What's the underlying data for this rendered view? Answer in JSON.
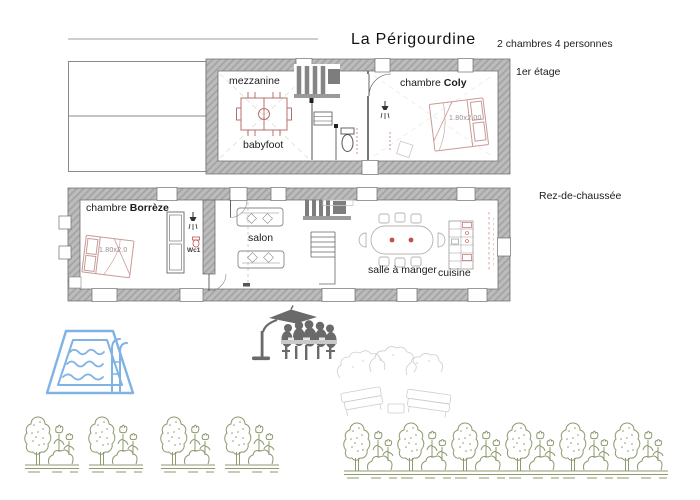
{
  "header": {
    "title": "La Périgourdine",
    "subtitle": "2 chambres 4 personnes"
  },
  "first_floor": {
    "label": "1er étage",
    "mezzanine": "mezzanine",
    "babyfoot": "babyfoot",
    "bedroom_prefix": "chambre ",
    "bedroom_name": "Coly",
    "bed_size": "1.80x2.00"
  },
  "ground_floor": {
    "label": "Rez-de-chaussée",
    "bedroom_prefix": "chambre ",
    "bedroom_name": "Borrèze",
    "bed_size": "1.80x2.0",
    "wc": "Wc1",
    "salon": "salon",
    "dining": "salle à manger",
    "kitchen": "cuisine"
  },
  "icons": {
    "pool": "pool-icon",
    "outdoor_dining": "umbrella-dining-silhouette-icon",
    "garden_sketch": "garden-furniture-sketch-icon",
    "garden_unit": "tree-bush-tulips-icon"
  },
  "garden": {
    "units_left": 4,
    "units_right": 6
  },
  "colors": {
    "wall_gray": "#bcbcbc",
    "wall_hatch": "#a2a2a2",
    "outline": "#6f6f6f",
    "furniture_red": "#c79b96",
    "accent_red": "#c0504d",
    "pool_blue": "#7fb2e5",
    "garden_green": "#8c9a6d",
    "silhouette_gray": "#6a6a6a",
    "text": "#1c1c1c"
  }
}
